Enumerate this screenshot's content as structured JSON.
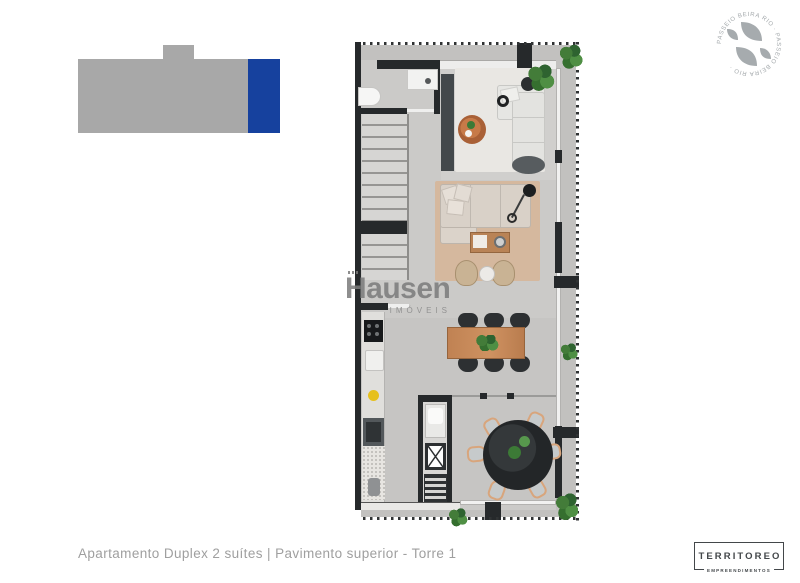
{
  "caption": "Apartamento Duplex  2 suítes |  Pavimento superior - Torre 1",
  "watermark": {
    "brand": "Hausen",
    "tagline": "IMÓVEIS"
  },
  "developer": {
    "name": "TERRITOREO",
    "subtitle": "EMPREENDIMENTOS"
  },
  "badge": {
    "ring_text": "PASSEIO BEIRA RIO · PASSEIO BEIRA RIO ·"
  },
  "locator": {
    "bar_color": "#a8a8a8",
    "highlight_color": "#16419e"
  },
  "colors": {
    "wall": "#26292b",
    "floor_interior": "#cbcac8",
    "floor_terrace": "#c2c1bf",
    "rug_white": "#e9e7e3",
    "rug_beige": "#d5b89e",
    "sofa_white": "#e6e6e3",
    "sofa_beige": "#dbd3ca",
    "wood": "#b98356",
    "table_black": "#232628",
    "plant_green": "#3c7a36",
    "yellow_item": "#e6c01c",
    "caption_gray": "#9f9f9f",
    "logo_dark": "#43474a",
    "badge_gray": "#a3a8ab"
  },
  "floorplan": {
    "title": "duplex-upper-floor-plan",
    "elements": [
      "bathroom-toilet",
      "bathroom-sink",
      "staircase",
      "tv-panel",
      "white-rug",
      "white-sofa",
      "ottoman",
      "oval-coffee-table",
      "beige-rug",
      "sectional-sofa",
      "coffee-table",
      "armchair",
      "armchair",
      "side-table",
      "arc-lamp",
      "dining-table",
      "dining-chairs",
      "kitchen-cooktop",
      "kitchen-sink",
      "kitchen-oven",
      "kitchen-counter",
      "duct-shaft",
      "vent-grill",
      "round-terrace-table",
      "terrace-chairs",
      "plants",
      "glass-wall",
      "projection-dotted-line"
    ]
  }
}
